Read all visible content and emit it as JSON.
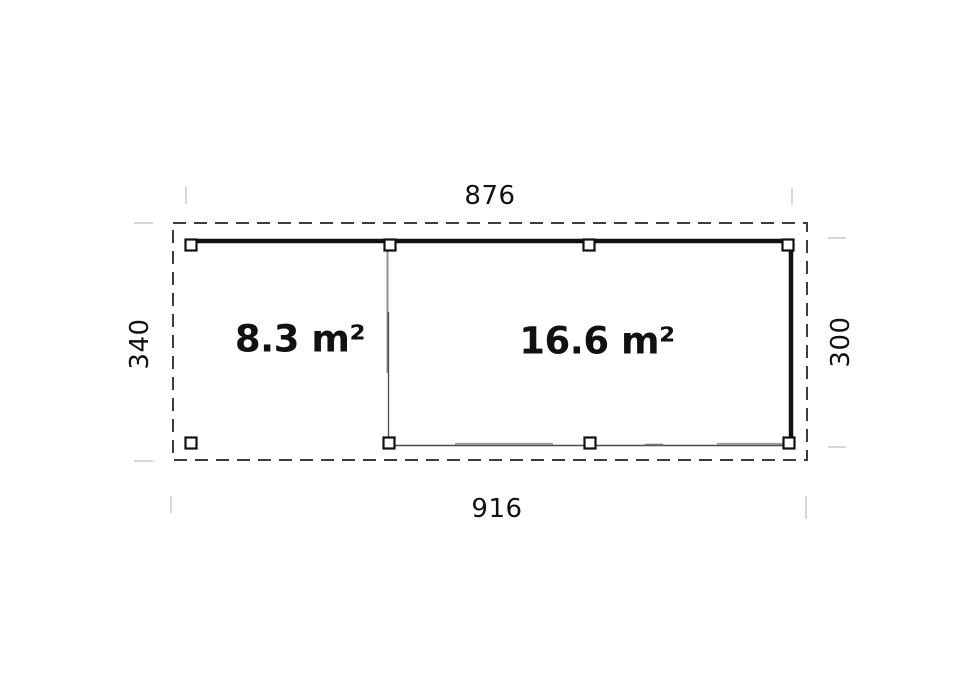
{
  "floor_plan": {
    "rooms": [
      {
        "id": "open-canopy-area",
        "area_label": "8.3 m²"
      },
      {
        "id": "enclosed-room",
        "area_label": "16.6 m²"
      }
    ],
    "dimensions": {
      "top_width": "876",
      "bottom_width": "916",
      "left_depth": "340",
      "right_depth": "300"
    },
    "colors": {
      "background": "#ffffff",
      "wall": "#111111",
      "dashed_outline": "#3d3d3d",
      "partition_gray": "#8f8f8f",
      "thin_wall": "#4a4a4a",
      "extension_line": "#c8c8c8",
      "text": "#111111"
    }
  }
}
